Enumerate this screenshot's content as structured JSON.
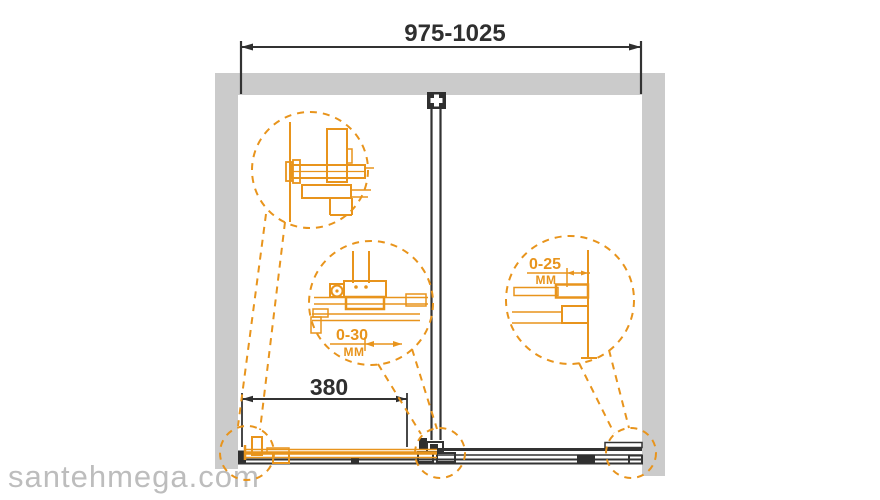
{
  "watermark": {
    "text": "santehmega.com"
  },
  "dimensions": {
    "overall_width": {
      "label": "975-1025"
    },
    "door_width": {
      "label": "380"
    },
    "floor_gap": {
      "value": "0-30",
      "unit": "MM"
    },
    "wall_adjustment": {
      "value": "0-25",
      "unit": "MM"
    }
  },
  "colors": {
    "accent_orange": "#e8941c",
    "wall_gray": "#cbcbcb",
    "line_dark": "#333333",
    "watermark_gray": "#bdbdbd"
  },
  "callouts": {
    "top_left": "wall-profile-section-detail",
    "middle": "roller-floor-gap-detail",
    "right": "wall-profile-adjustment-detail"
  }
}
